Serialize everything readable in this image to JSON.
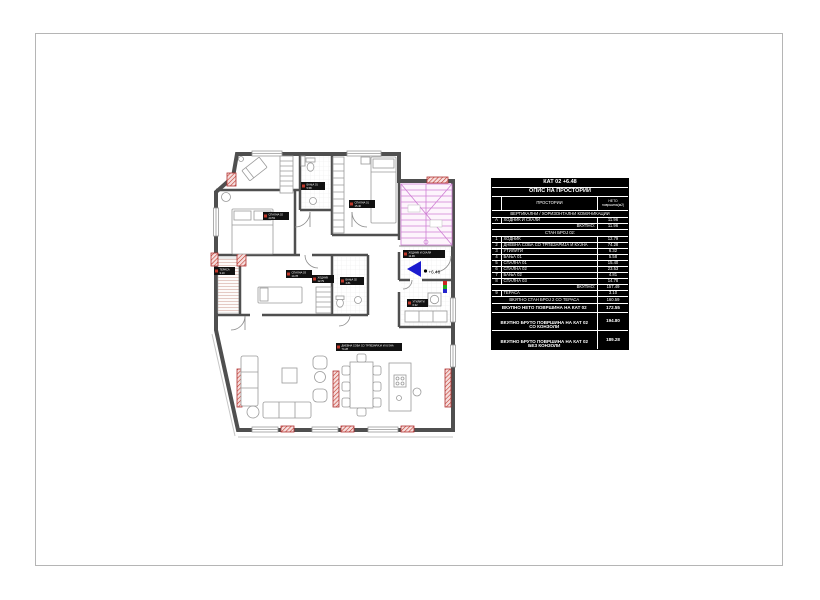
{
  "sheet": {
    "type": "architectural-floor-plan",
    "border_color": "#b5b5b5"
  },
  "table": {
    "title1": "КАТ 02 +6.48",
    "title2": "ОПИС НА ПРОСТОРИИ",
    "col_name": "ПРОСТОРИИ",
    "col_area_line1": "НЕТО",
    "col_area_line2": "површина(м2)",
    "section1": "ВЕРТИКАЛНИ / ХОРИЗОНТАЛНИ КОМУНИКАЦИИ",
    "rowA": {
      "no": "А",
      "name": "ХОДНИК И СКАЛИ",
      "area": "11.96"
    },
    "subtotal1": {
      "label": "ВКУПНО:",
      "value": "11.96"
    },
    "section2": "СТАН БРОЈ 02:",
    "rooms": [
      {
        "no": "1",
        "name": "ХОДНИК",
        "area": "12.79"
      },
      {
        "no": "2",
        "name": "ДНЕВНА СОБА СО ТРПЕЗАРИЈА И КУЈНА",
        "area": "74.28"
      },
      {
        "no": "3",
        "name": "УТИЛИТИ",
        "area": "6.32"
      },
      {
        "no": "4",
        "name": "БАЊА 01",
        "area": "5.58"
      },
      {
        "no": "5",
        "name": "СПАЛНА 01",
        "area": "15.40"
      },
      {
        "no": "6",
        "name": "СПАЛНА 02",
        "area": "23.53"
      },
      {
        "no": "7",
        "name": "БАЊА 02",
        "area": "4.81"
      },
      {
        "no": "8",
        "name": "СПАЛНА 03",
        "area": "14.78"
      }
    ],
    "subtotal2": {
      "label": "ВКУПНО:",
      "value": "157.49"
    },
    "terrace": {
      "no": "9",
      "name": "ТЕРАСА",
      "area": "3.10"
    },
    "totals": [
      {
        "line1": "ВКУПНО СТАН БРОЈ 2 СО ТЕРАСА",
        "line2": "",
        "value": "160.59"
      },
      {
        "line1": "ВКУПНО НЕТО ПОВРШИНА НА КАТ 02",
        "line2": "",
        "value": "172.55"
      },
      {
        "line1": "ВКУПНО БРУТО ПОВРШИНА НА КАТ 02",
        "line2": "СО КОНЗОЛИ",
        "value": "194.80"
      },
      {
        "line1": "ВКУПНО БРУТО ПОВРШИНА НА КАТ 02",
        "line2": "БЕЗ КОНЗОЛИ",
        "value": "189.28"
      }
    ]
  },
  "plan": {
    "level_label": "+6.48",
    "tags": [
      {
        "name": "ХОДНИК И СКАЛИ",
        "area": "11.96"
      },
      {
        "name": "БАЊА 01",
        "area": "5.58"
      },
      {
        "name": "СПАЛНА 01",
        "area": "15.40"
      },
      {
        "name": "СПАЛНА 02",
        "area": "23.53"
      },
      {
        "name": "СПАЛНА 03",
        "area": "14.78"
      },
      {
        "name": "ХОДНИК",
        "area": "12.79"
      },
      {
        "name": "БАЊА 02",
        "area": "4.81"
      },
      {
        "name": "ТЕРАСА",
        "area": "3.10"
      },
      {
        "name": "УТИЛИТИ",
        "area": "6.32"
      },
      {
        "name": "ДНЕВНА СОБА СО ТРПЕЗАРИЈА И КУЈНА",
        "area": "74.28"
      }
    ],
    "colors": {
      "wall": "#4f4f4f",
      "column_red": "#c0392b",
      "stair_magenta": "#cf7fd4",
      "entrance_arrow_blue": "#1b1bcf",
      "furniture": "#9a9a9a",
      "terrace_hatch": "#d4a9a0"
    }
  }
}
